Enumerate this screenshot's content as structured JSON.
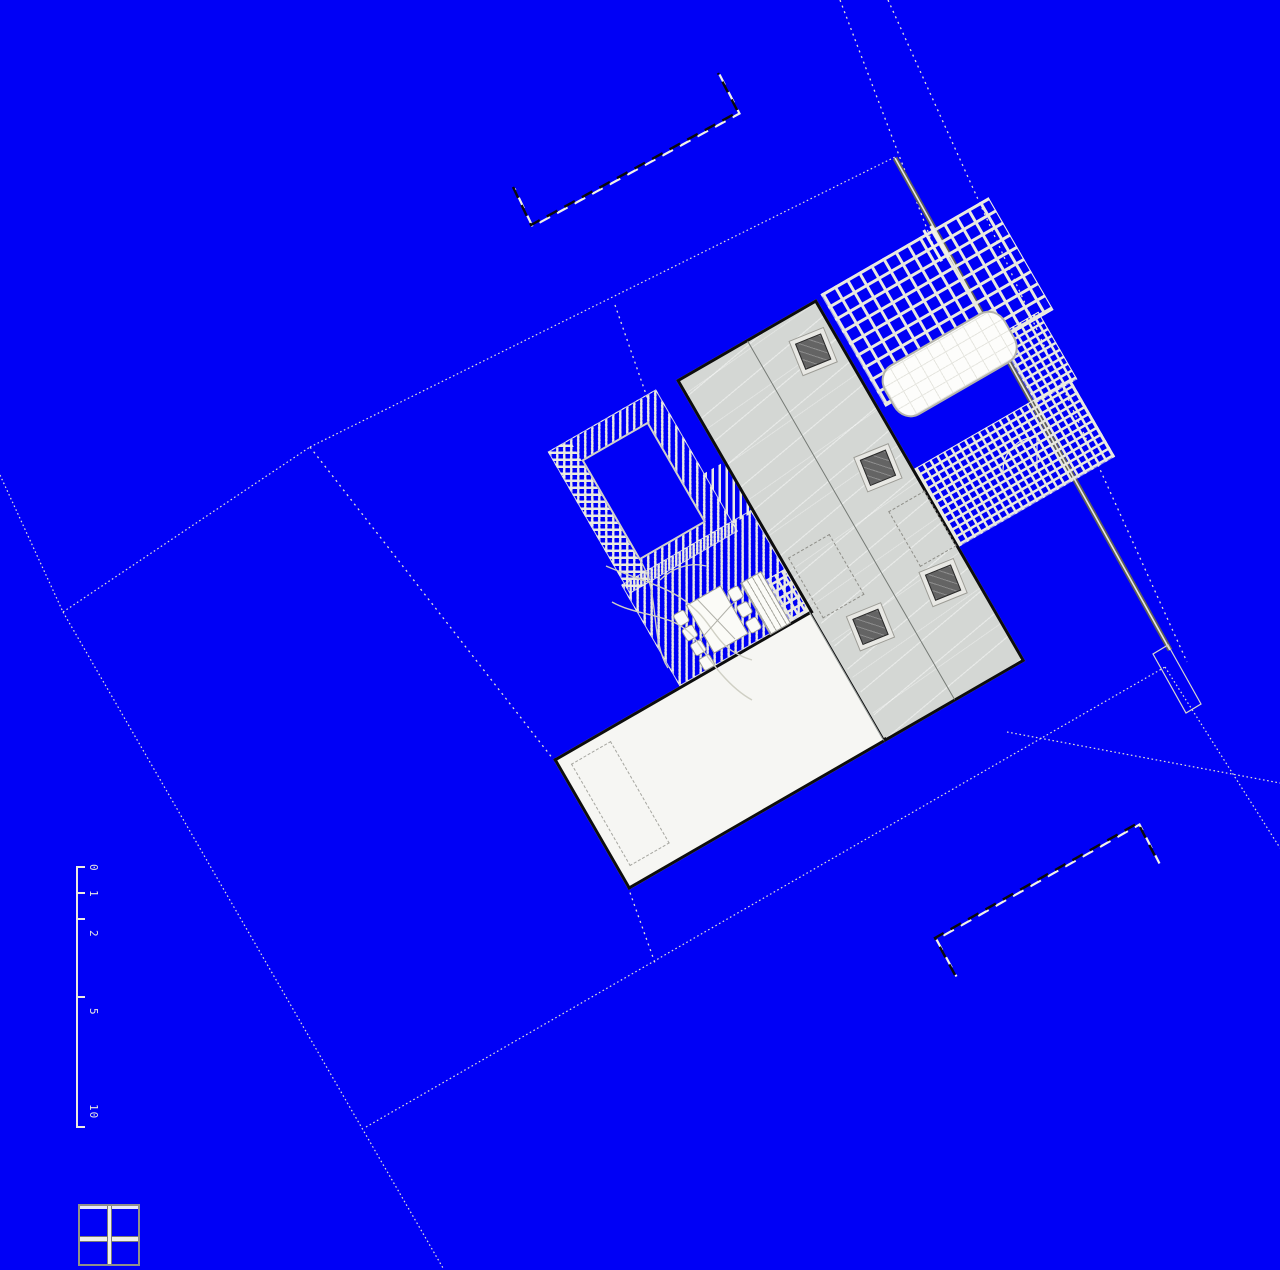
{
  "scale_bar": {
    "labels": [
      "0",
      "1",
      "2",
      "5",
      "10"
    ]
  },
  "colors": {
    "background": "#0000f6",
    "roof": "#d4d7d4",
    "wing": "#f6f6f3",
    "building_outline": "#0d0d0d",
    "skylight": "#646464",
    "tile_grout": "#e9e9df",
    "deck_stripe": "#ebebe1",
    "fence": "#60605a",
    "boundary_line": "#e4e2d6",
    "neighbor_dash": "#0a0a0a"
  },
  "features": {
    "skylight_count": 4,
    "chair_count": 7,
    "legend_icon": "window-grid-icon"
  }
}
